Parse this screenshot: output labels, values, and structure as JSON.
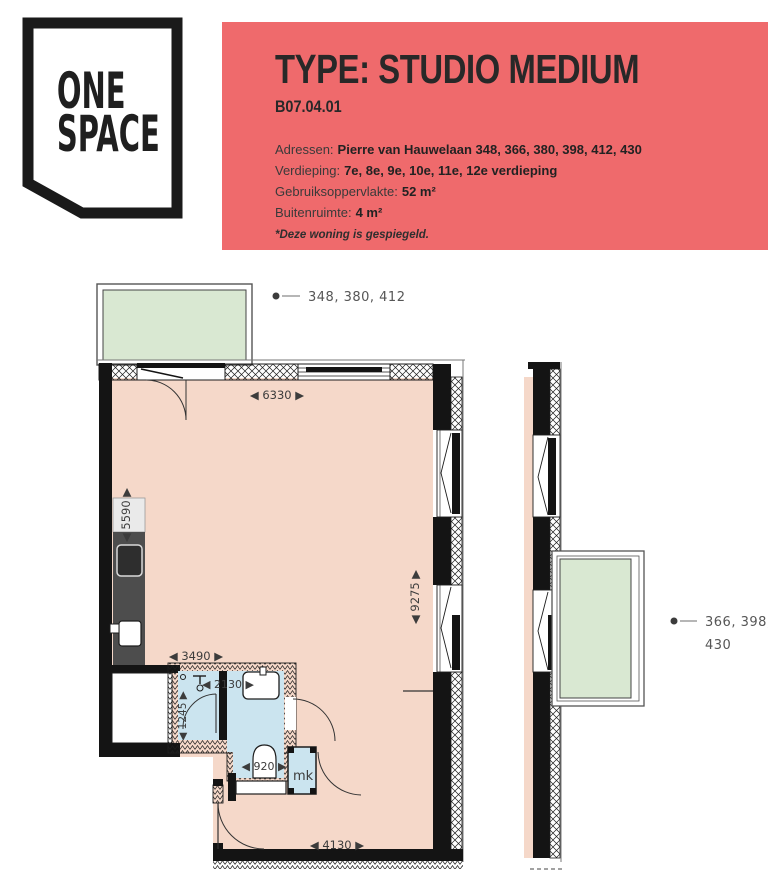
{
  "logo": {
    "line1": "ONE",
    "line2": "SPACE"
  },
  "header": {
    "title": "TYPE: STUDIO MEDIUM",
    "code": "B07.04.01",
    "details": [
      {
        "label": "Adressen:",
        "value": "Pierre van Hauwelaan 348, 366, 380, 398, 412, 430"
      },
      {
        "label": "Verdieping:",
        "value": "7e, 8e, 9e, 10e, 11e, 12e verdieping"
      },
      {
        "label": "Gebruiksoppervlakte:",
        "value": "52 m²"
      },
      {
        "label": "Buitenruimte:",
        "value": "4 m²"
      }
    ],
    "note": "*Deze woning is gespiegeld.",
    "accent_color": "#ef6a6c"
  },
  "plan": {
    "leader_left": "348, 380, 412",
    "leader_right_line1": "366, 398,",
    "leader_right_line2": "430",
    "mk_label": "mk",
    "dim_top": "◀ 6330 ▶",
    "dim_right": "◀ 9275 ▶",
    "dim_kitchen_len": "◀ 5590 ▶",
    "dim_kitchen_w": "◀ 3490 ▶",
    "dim_bath_w": "◀ 2130 ▶",
    "dim_bath_h": "◀ 1245 ▶",
    "dim_wc": "◀ 920 ▶",
    "dim_hall": "◀ 4130 ▶",
    "colors": {
      "room": "#f5d8c9",
      "balcony": "#d9e8d2",
      "bathroom": "#cbe4ef",
      "counter": "#4d4d4d",
      "wall": "#141414",
      "dim_text": "#3c3c3c",
      "leader_text": "#565656"
    }
  }
}
